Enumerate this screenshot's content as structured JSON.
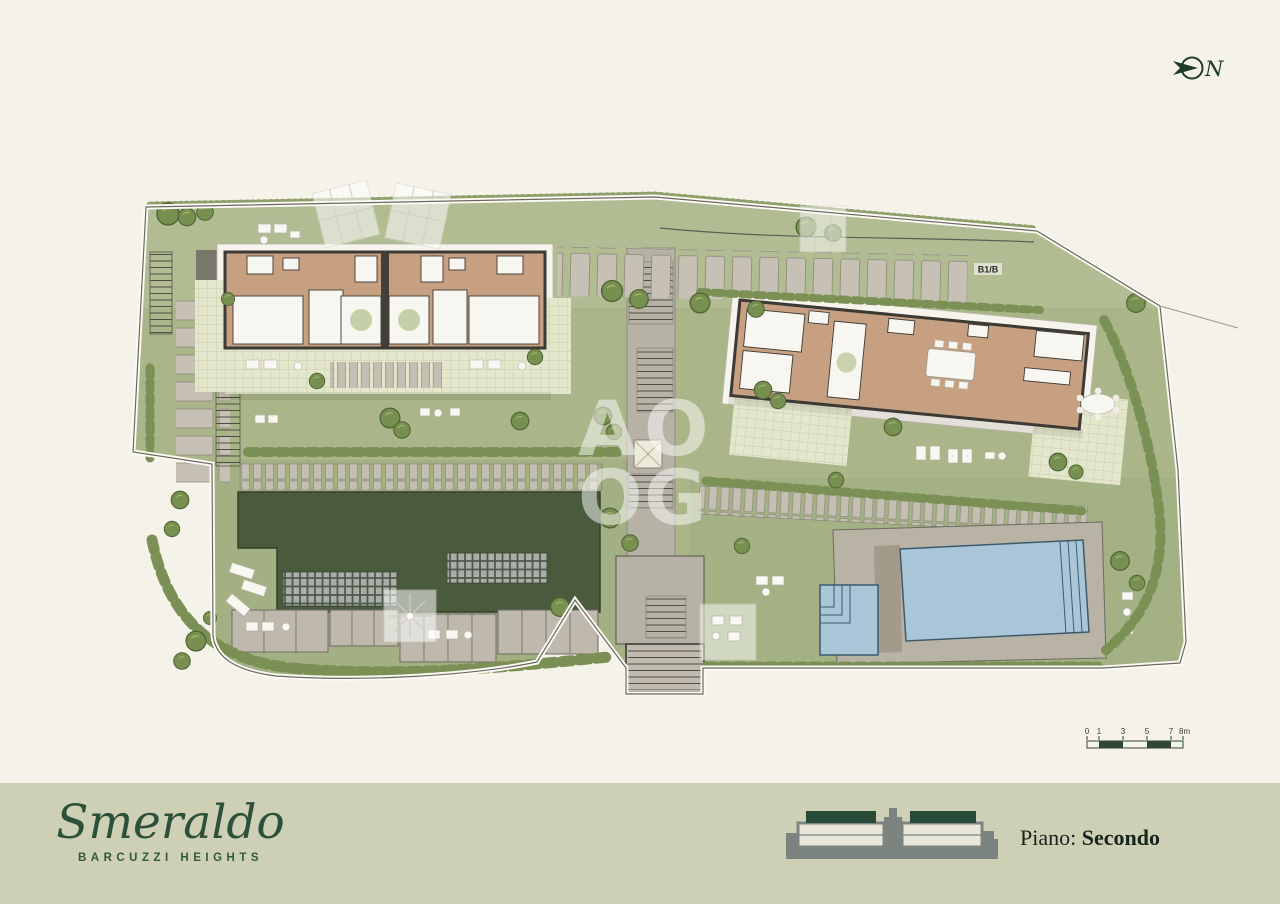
{
  "north": {
    "label": "N"
  },
  "watermark": {
    "letters": [
      "A",
      "O",
      "O",
      "G"
    ]
  },
  "plan": {
    "unit_label": "B1/B"
  },
  "scale_bar": {
    "ticks": [
      "0",
      "1",
      "3",
      "5",
      "7",
      "8m"
    ]
  },
  "footer": {
    "brand_name": "Smeraldo",
    "brand_subtitle": "BARCUZZI HEIGHTS",
    "floor_label": "Piano:",
    "floor_value": "Secondo"
  },
  "colors": {
    "background": "#f5f2e9",
    "footer_bg": "#ced0b6",
    "brand_green": "#2d5138",
    "dark_green": "#274b36",
    "lawn": "#aab689",
    "lawn_light": "#b6c098",
    "garden": "#9cab80",
    "path_gray": "#c0bbae",
    "wall": "#3b3a35",
    "wood": "#c7a081",
    "room_white": "#f7f6f0",
    "tile": "#e4e7cc",
    "roof_green": "#4a5a3c",
    "tree": "#78904f",
    "hedge": "#7b9054",
    "pool": "#a9c6d8",
    "deck": "#b9b3a6",
    "watermark_white": "#ffffff",
    "boundary": "#6b685e"
  }
}
